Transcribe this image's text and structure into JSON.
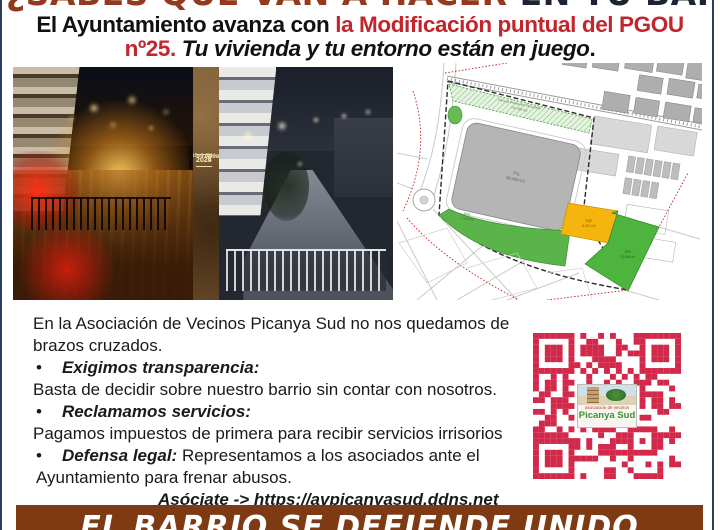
{
  "colors": {
    "border": "#2a3f63",
    "headline_brown": "#93391c",
    "headline_dark": "#1c2433",
    "accent_red": "#c2262c",
    "banner_brown": "#7d3a13",
    "qr_red": "#d2294b",
    "map_green": "#58b348",
    "map_yellow": "#f6b40e"
  },
  "headline": {
    "part1": "¿SABES QUÉ VAN A HACER",
    "part2": " EN TU BARRIO?"
  },
  "subheadline": {
    "prefix": "El Ayuntamiento avanza con ",
    "highlight": "la Modificación puntual del PGOU nº25.",
    "emphasis": " Tu vivienda y tu entorno están en juego",
    "suffix": "."
  },
  "photos": {
    "caption": {
      "place": "Picanya",
      "year_from": "2024",
      "year_to": "2025",
      "slogan_line1": "La lluita",
      "slogan_line2": "d'un poble"
    }
  },
  "plan_map": {
    "zone_protection": "Zona de Protección Ferroviaria",
    "zone_protection_area": "≈10.445 m2",
    "zone_main": "PJL",
    "zone_main_area": "38.406 m2",
    "zone_eqe": "EQE",
    "zone_eqe_area": "5.247 m2",
    "zone_evp": "EVP",
    "zone_evp_area": "10.818 m2",
    "zone_evj": "EVJ",
    "zone_evj_area": "7.132 m2"
  },
  "body": {
    "intro": "En la Asociación de Vecinos Picanya Sud no nos quedamos de brazos cruzados.",
    "bullets": [
      {
        "title": "Exigimos transparencia:",
        "text": "Basta de decidir sobre nuestro barrio sin contar con nosotros."
      },
      {
        "title": "Reclamamos servicios:",
        "text": "Pagamos impuestos de primera para recibir servicios irrisorios"
      },
      {
        "title": "Defensa legal:",
        "text": "Representamos a los asociados  ante el Ayuntamiento para frenar abusos."
      }
    ],
    "cta": "Asóciate  -> https://avpicanyasud.ddns.net"
  },
  "qr": {
    "color": "#d2294b",
    "logo_small": "asociación de vecinos",
    "logo_text": "Picanya Sud"
  },
  "banner": {
    "text": "EL BARRIO SE DEFIENDE UNIDO",
    "background": "#7d3a13"
  }
}
